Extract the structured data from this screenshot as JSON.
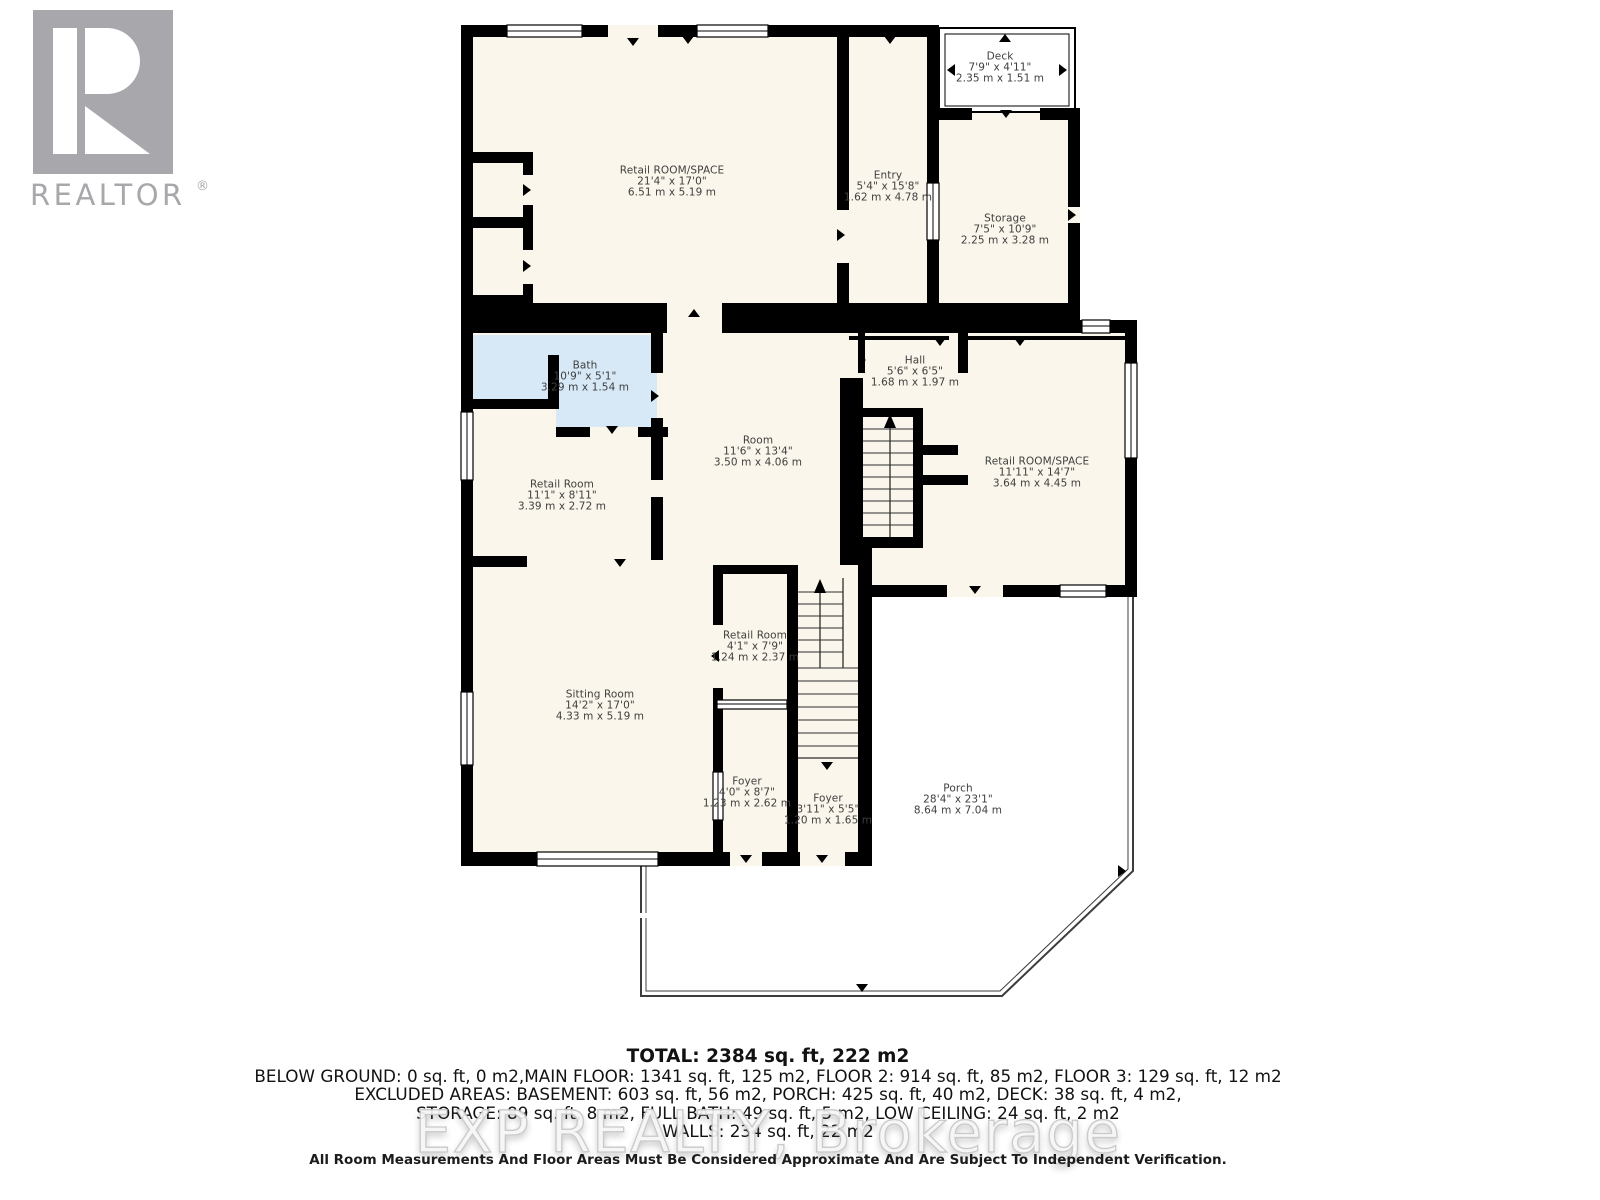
{
  "branding": {
    "logo_text": "REALTOR",
    "registered_mark": "®"
  },
  "watermark": {
    "text": "EXP REALTY, Brokerage"
  },
  "rooms": [
    {
      "name": "Retail ROOM/SPACE",
      "imperial": "21'4\" x 17'0\"",
      "metric": "6.51 m x 5.19 m"
    },
    {
      "name": "Entry",
      "imperial": "5'4\" x 15'8\"",
      "metric": "1.62 m x 4.78 m"
    },
    {
      "name": "Deck",
      "imperial": "7'9\" x 4'11\"",
      "metric": "2.35 m x 1.51 m"
    },
    {
      "name": "Storage",
      "imperial": "7'5\" x 10'9\"",
      "metric": "2.25 m x 3.28 m"
    },
    {
      "name": "Bath",
      "imperial": "10'9\" x 5'1\"",
      "metric": "3.29 m x 1.54 m"
    },
    {
      "name": "Retail Room",
      "imperial": "11'1\" x 8'11\"",
      "metric": "3.39 m x 2.72 m"
    },
    {
      "name": "Room",
      "imperial": "11'6\" x 13'4\"",
      "metric": "3.50 m x 4.06 m"
    },
    {
      "name": "Hall",
      "imperial": "5'6\" x 6'5\"",
      "metric": "1.68 m x 1.97 m"
    },
    {
      "name": "Retail ROOM/SPACE",
      "imperial": "11'11\" x 14'7\"",
      "metric": "3.64 m x 4.45 m"
    },
    {
      "name": "Sitting Room",
      "imperial": "14'2\" x 17'0\"",
      "metric": "4.33 m x 5.19 m"
    },
    {
      "name": "Retail Room",
      "imperial": "4'1\" x 7'9\"",
      "metric": "1.24 m x 2.37 m"
    },
    {
      "name": "Foyer",
      "imperial": "4'0\" x 8'7\"",
      "metric": "1.23 m x 2.62 m"
    },
    {
      "name": "Foyer",
      "imperial": "3'11\" x 5'5\"",
      "metric": "1.20 m x 1.65 m"
    },
    {
      "name": "Porch",
      "imperial": "28'4\" x 23'1\"",
      "metric": "8.64 m x 7.04 m"
    }
  ],
  "summary": {
    "total": "TOTAL: 2384 sq. ft, 222 m2",
    "line2": "BELOW GROUND: 0 sq. ft, 0 m2,MAIN FLOOR: 1341 sq. ft, 125 m2, FLOOR 2: 914 sq. ft, 85 m2, FLOOR 3: 129 sq. ft, 12 m2",
    "line3": "EXCLUDED AREAS: BASEMENT: 603 sq. ft, 56 m2, PORCH: 425 sq. ft, 40 m2, DECK: 38 sq. ft, 4 m2,",
    "line4": "STORAGE: 89 sq. ft, 8 m2, FULL BATH: 49 sq. ft, 5 m2, LOW CEILING: 24 sq. ft, 2 m2",
    "line5": "WALLS: 234 sq. ft, 22 m2"
  },
  "disclaimer": "All Room Measurements And Floor Areas Must Be Considered Approximate And Are Subject To Independent Verification.",
  "colors": {
    "wall": "#000000",
    "floor": "#FAF6EB",
    "bath": "#D7E8F7",
    "label": "#3F3F3F",
    "logo_gray": "#A8A8AC",
    "watermark": "#F6F6F6"
  }
}
